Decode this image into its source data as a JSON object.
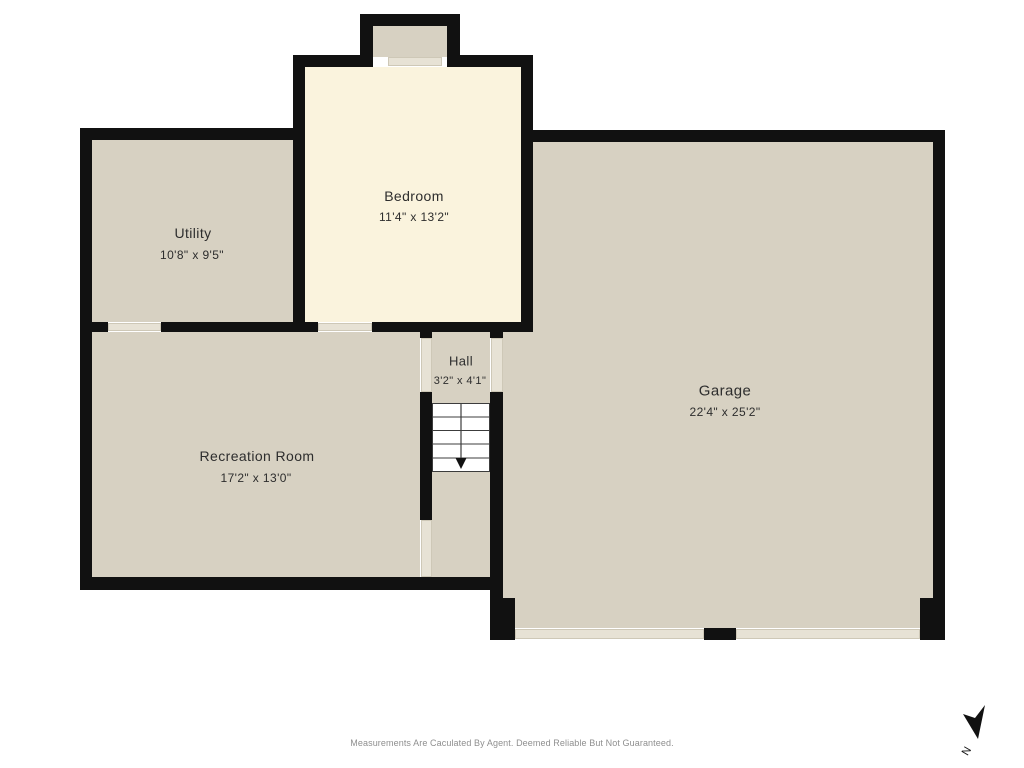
{
  "plan": {
    "rooms": [
      {
        "name": "Utility",
        "dimensions": "10'8\" x 9'5\""
      },
      {
        "name": "Bedroom",
        "dimensions": "11'4\" x 13'2\""
      },
      {
        "name": "Hall",
        "dimensions": "3'2\" x 4'1\""
      },
      {
        "name": "Recreation Room",
        "dimensions": "17'2\" x 13'0\""
      },
      {
        "name": "Garage",
        "dimensions": "22'4\" x 25'2\""
      }
    ],
    "stairs": {
      "direction": "down"
    },
    "compass": {
      "label": "N"
    },
    "footer": "Measurements Are Caculated By Agent. Deemed Reliable But Not Guaranteed.",
    "colors": {
      "wall": "#111111",
      "floor_tan": "#d7d1c2",
      "floor_cream": "#faf3dd",
      "door_opening": "#e7e2d5",
      "outside": "#ffffff"
    }
  }
}
